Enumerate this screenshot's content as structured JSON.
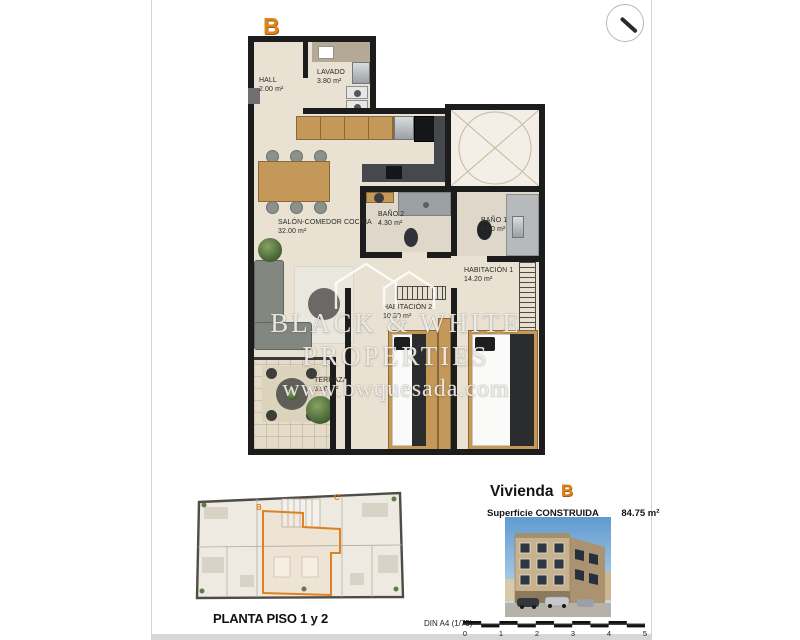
{
  "colors": {
    "accent": "#E0801F",
    "wall": "#1C1C1C"
  },
  "page": {
    "unit_letter": "B"
  },
  "floorplan": {
    "rooms": [
      {
        "name": "HALL",
        "area": "2.00 m²"
      },
      {
        "name": "LAVADO",
        "area": "3.80 m²"
      },
      {
        "name": "SALÓN-COMEDOR COCINA",
        "area": "32.00 m²"
      },
      {
        "name": "BAÑO 2",
        "area": "4.30 m²"
      },
      {
        "name": "BAÑO 1",
        "area": "4.00 m²"
      },
      {
        "name": "HABITACIÓN 1",
        "area": "14.20 m²"
      },
      {
        "name": "HABITACIÓN 2",
        "area": "10.50 m²"
      },
      {
        "name": "TERRAZA",
        "area": "6.50 m²"
      }
    ]
  },
  "watermark": {
    "line1": "BLACK & WHITE",
    "line2": "PROPERTIES",
    "line3": "www.bwquesada.com"
  },
  "mini_plan": {
    "label": "PLANTA PISO 1 y 2",
    "marks": [
      "B",
      "C"
    ]
  },
  "info": {
    "title_prefix": "Vivienda",
    "title_letter": "B",
    "surface_label": "Superficie CONSTRUIDA",
    "surface_value": "84.75 m²"
  },
  "scalebar": {
    "label": "DIN A4 (1/75)",
    "ticks": [
      "0",
      "1",
      "2",
      "3",
      "4",
      "5"
    ]
  }
}
